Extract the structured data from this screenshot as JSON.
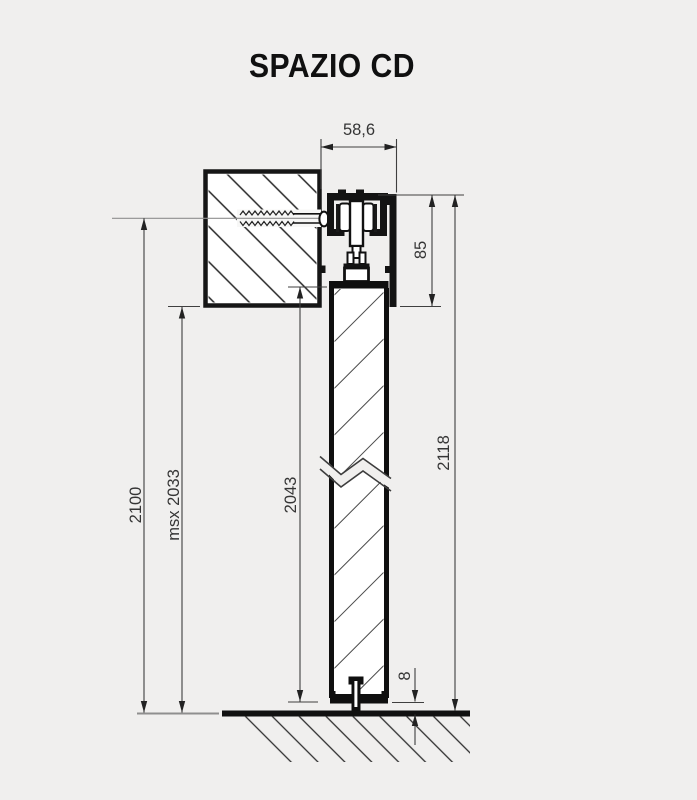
{
  "title": "SPAZIO CD",
  "drawing": {
    "kind": "sliding-door-system-vertical-section",
    "dimensions": {
      "track_width": "58,6",
      "carriage_height": "85",
      "total_height": "2118",
      "passage_height": "2100",
      "msx_height": "msx 2033",
      "door_height": "2043",
      "floor_gap": "8"
    },
    "palette": {
      "background": "#f0efee",
      "line": "#161616",
      "dimension_line": "#3f3f3f",
      "thin_reference": "#8f8f8f",
      "panel_fill": "#ffffff"
    }
  }
}
